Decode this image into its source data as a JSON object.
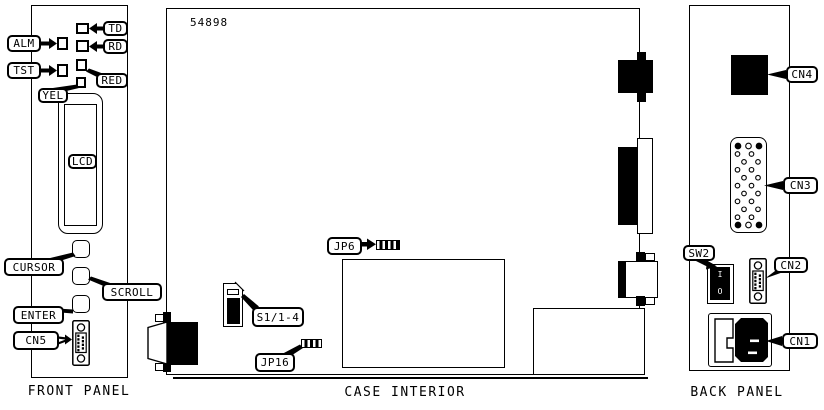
{
  "part_number": "54898",
  "captions": {
    "front": "FRONT PANEL",
    "case": "CASE INTERIOR",
    "back": "BACK PANEL"
  },
  "labels": {
    "alm": "ALM",
    "tst": "TST",
    "td": "TD",
    "rd": "RD",
    "red": "RED",
    "yel": "YEL",
    "lcd": "LCD",
    "cursor": "CURSOR",
    "scroll": "SCROLL",
    "enter": "ENTER",
    "cn5": "CN5",
    "jp6": "JP6",
    "s1": "S1/1-4",
    "jp16": "JP16",
    "sw2": "SW2",
    "cn4": "CN4",
    "cn3": "CN3",
    "cn2": "CN2",
    "cn1": "CN1"
  },
  "switch_markings": {
    "on": "I",
    "off": "O"
  },
  "colors": {
    "ink": "#000000",
    "paper": "#ffffff"
  }
}
